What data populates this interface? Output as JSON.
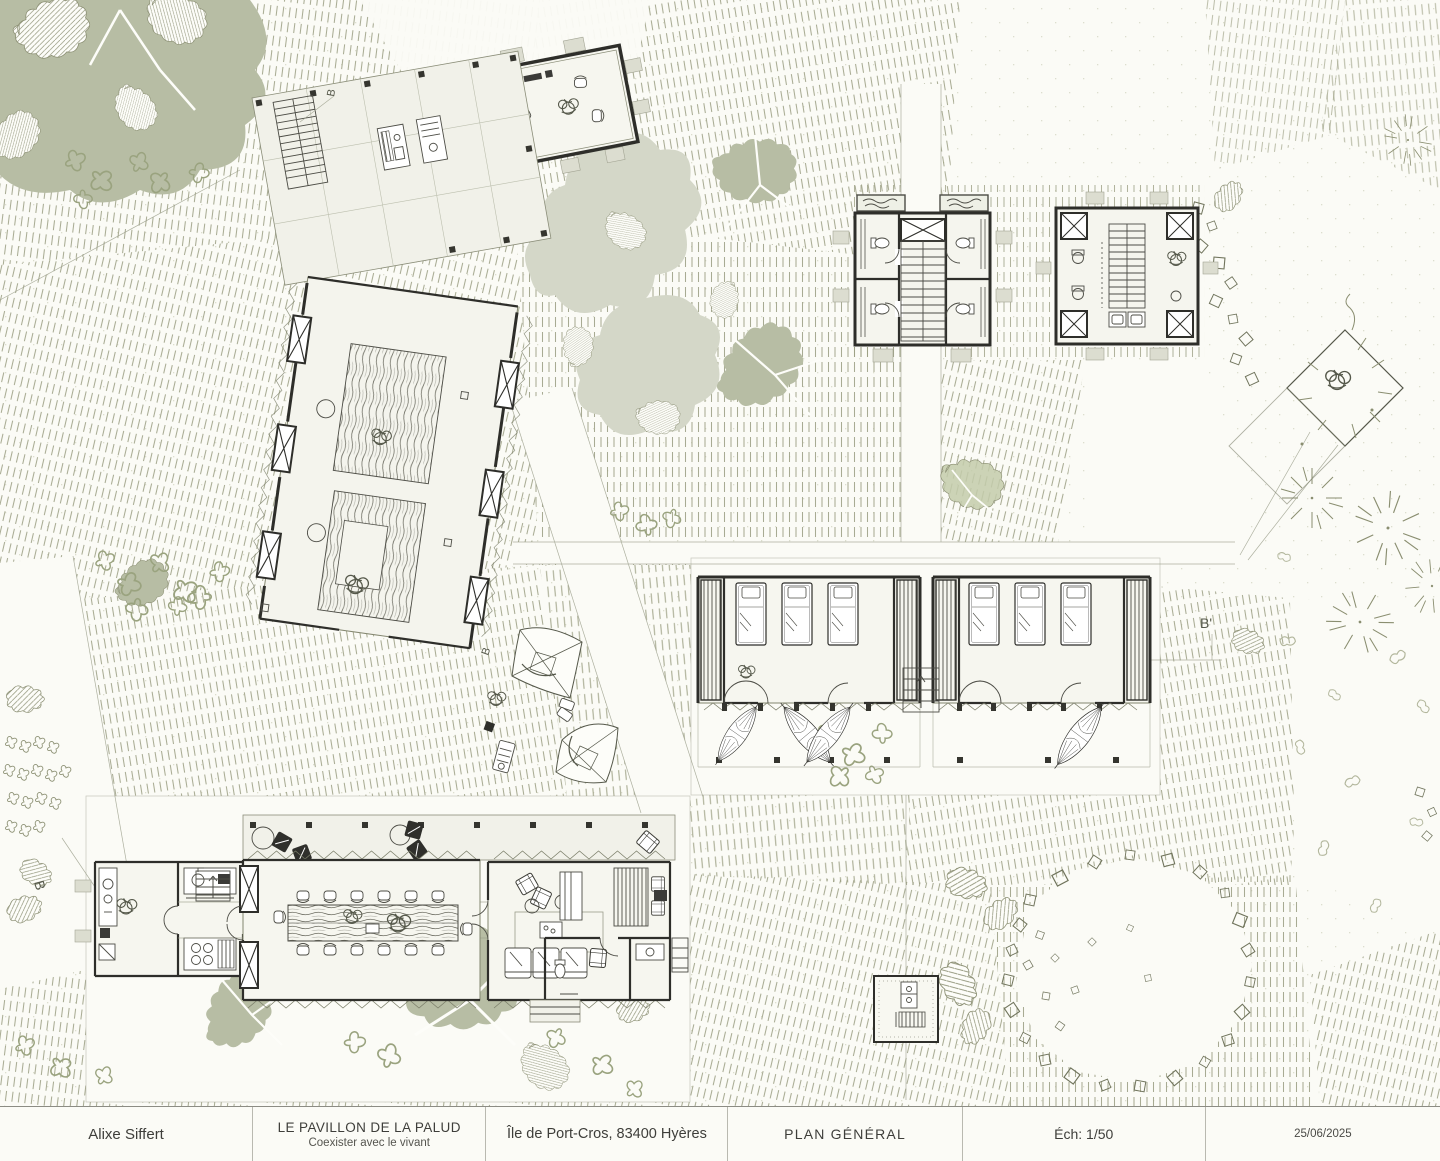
{
  "titleblock": {
    "author": "Alixe Siffert",
    "project_title": "LE PAVILLON DE LA PALUD",
    "project_subtitle": "Coexister avec le vivant",
    "location": "Île de Port-Cros, 83400 Hyères",
    "drawing_title": "PLAN GÉNÉRAL",
    "scale_label": "Éch: 1/50",
    "date": "25/06/2025"
  },
  "markers": {
    "section_b_left": "B",
    "section_b_top": "B",
    "section_b_mid": "B",
    "section_b_prime": "B'"
  },
  "palette": {
    "paper": "#fbfbf6",
    "ink": "#2e2e2a",
    "line": "#72755f",
    "hatch": "#9a9e81",
    "sage_dark": "#b7bda4",
    "sage_light": "#d4d7c8",
    "leaf": "#c3cbaa",
    "wood": "#6b6b60",
    "title_text": "#3e3e3a"
  }
}
